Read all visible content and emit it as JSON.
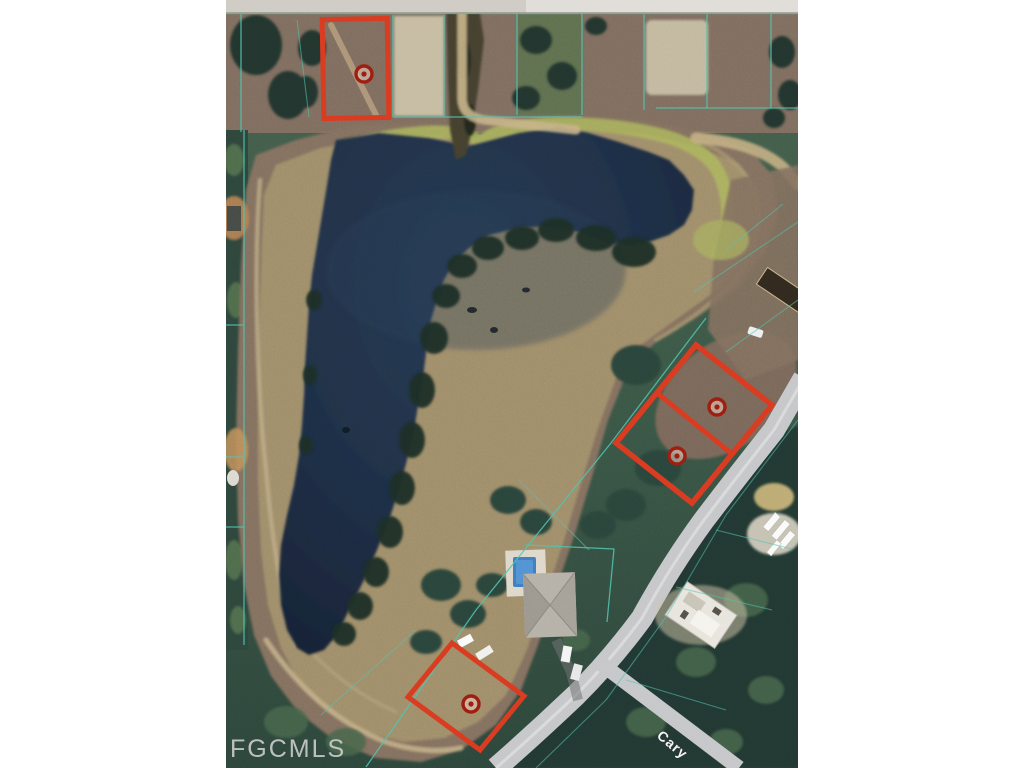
{
  "map": {
    "watermark": "FGCMLS",
    "street_label": "Cary",
    "colors": {
      "highlight_outline": "#d93a20",
      "marker_ring": "#9c1d10",
      "parcel_line": "#4fc3ae",
      "water": "#1c2b3e",
      "road": "#c6c7c9",
      "dirt_bank": "#84705e",
      "vegetation": "#3f5a49",
      "watermark": "#c9c9c9",
      "background": "#ffffff"
    },
    "highlighted_parcels": [
      {
        "id": "north-lot",
        "shape": "rectangle",
        "markers": 1
      },
      {
        "id": "east-lot-upper",
        "shape": "parallelogram",
        "markers": 1
      },
      {
        "id": "east-lot-lower",
        "shape": "parallelogram",
        "markers": 1
      },
      {
        "id": "south-lot",
        "shape": "parallelogram",
        "markers": 1
      }
    ],
    "marker_count": 4
  }
}
